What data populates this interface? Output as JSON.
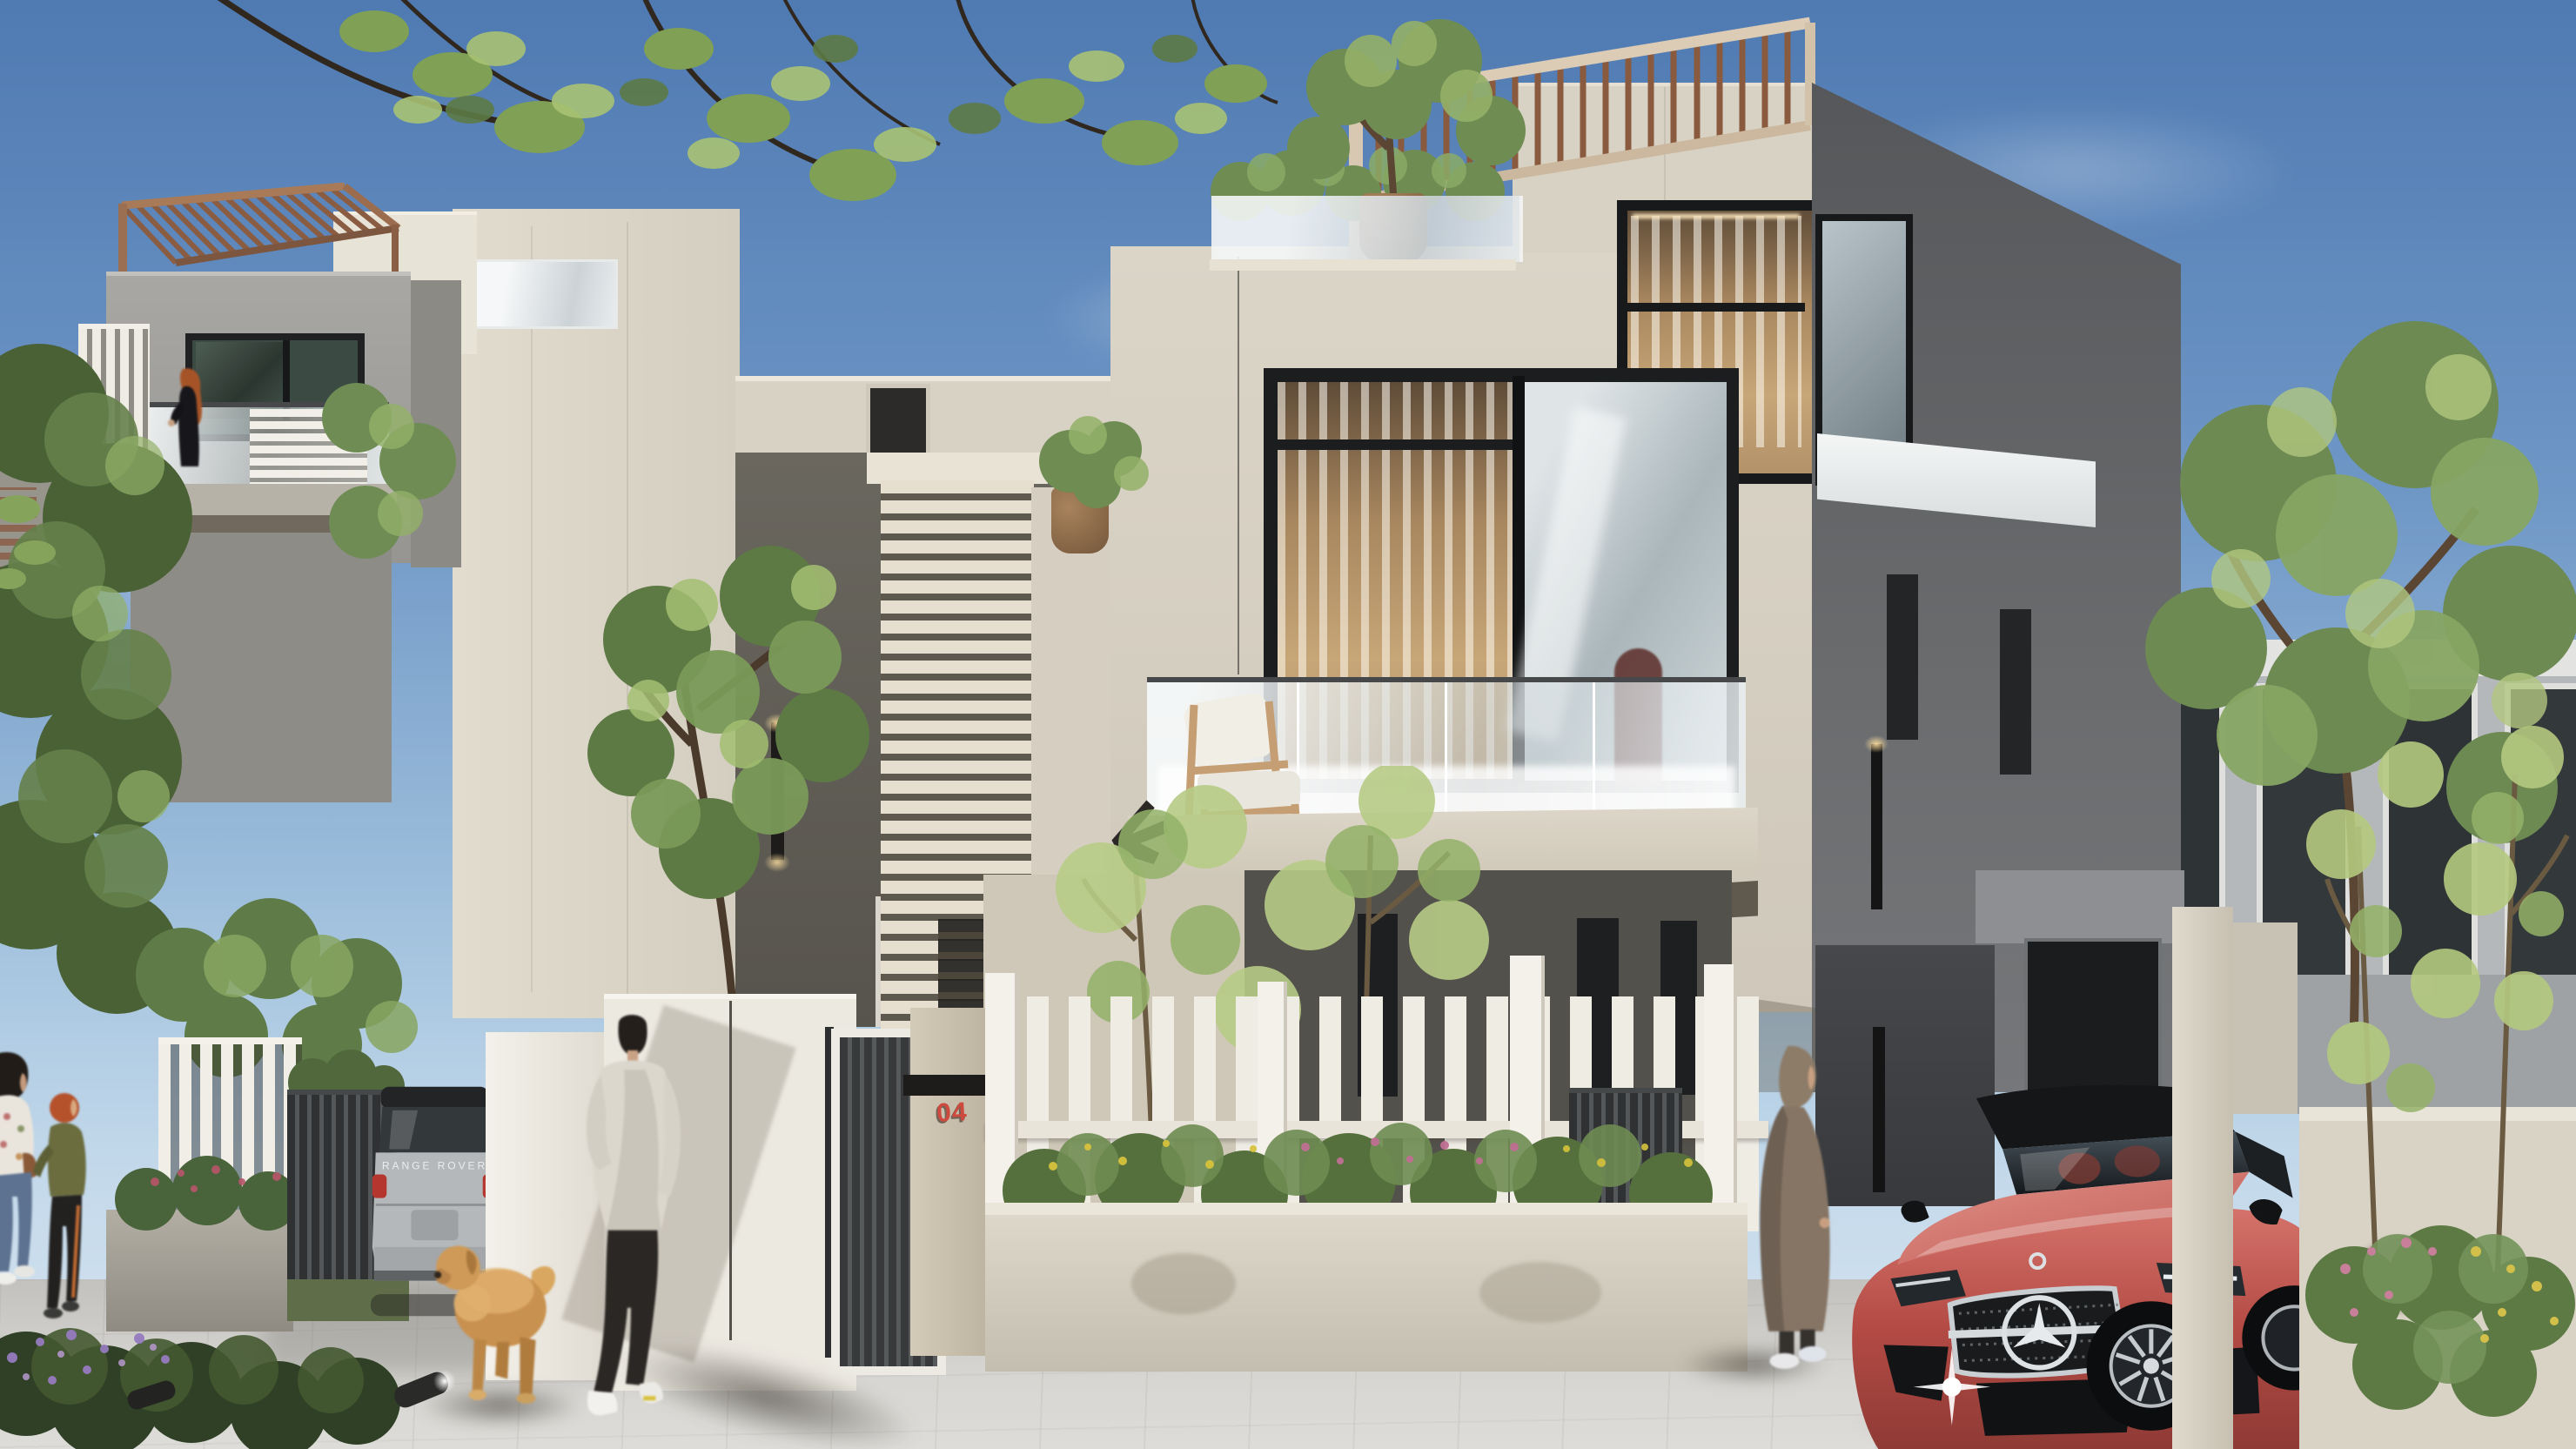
{
  "scene": {
    "description": "Daytime architectural rendering of a modern residential compound: two cubic concrete villas with rooftop wooden pergolas, glass balcony railings, white picket fences with landscaped planters, a parked silver Range Rover, a red Mercedes sedan, pedestrians, a golden retriever and street trees under a clear blue sky.",
    "time_of_day": "day",
    "sky": "clear blue with thin wispy clouds"
  },
  "texts": {
    "house_number": "04",
    "suv_tailgate": "RANGE ROVER"
  },
  "palette": {
    "sky_top": "#4f7ab2",
    "sky_horizon": "#dae7f2",
    "cream_sunlit": "#e3ddd0",
    "cream_wall": "#d7d1c4",
    "cream_shadow": "#b6b1a6",
    "gray_wall": "#a4a39f",
    "dark_gray_wall": "#55575a",
    "charcoal_slats": "#333536",
    "pergola_wood": "#8a5a3e",
    "pergola_frame": "#dac9b3",
    "glass_blue": "#cfd8da",
    "rail_glass": "#eef3f5",
    "foliage_dark": "#42572f",
    "foliage_mid": "#6f8c52",
    "foliage_light": "#a9c273",
    "flower_yellow": "#d6c23c",
    "flower_pink": "#c06f93",
    "flower_purple": "#967bbf",
    "car_red": "#c05650",
    "car_red_deep": "#8e3a35",
    "suv_silver": "#b5b9bc",
    "pavement": "#d0cfcb",
    "shadow": "#6f6a60",
    "house_number_red": "#ce4a3e",
    "chair_wood": "#c79f72",
    "terracotta": "#9c7a58"
  },
  "inventory": [
    "left villa with rooftop pergola",
    "main villa with rooftop pergola and roof terrace",
    "corner windows with black frames",
    "balcony with glass railing and wooden armchair",
    "woman standing on left balcony",
    "wall-mounted developer logo",
    "house number pillar 04",
    "entry gates with dark louvers",
    "white picket fence with flowering planters",
    "silver range rover suv (rear view)",
    "red mercedes sedan (front view)",
    "man walking away",
    "golden retriever dog",
    "woman in long coat and headscarf",
    "mother and child walking",
    "street trees, shrubs and garden spotlights",
    "paved driveway"
  ]
}
